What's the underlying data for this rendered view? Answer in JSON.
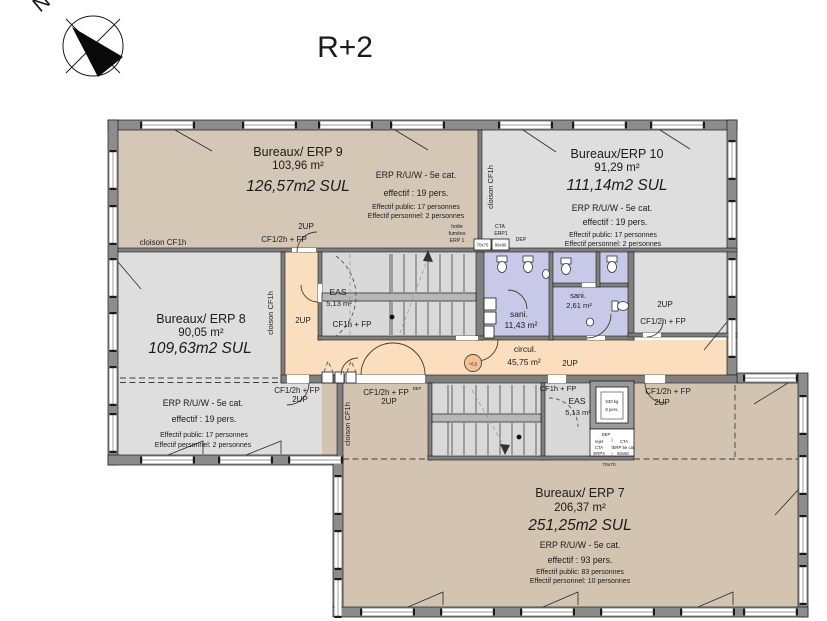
{
  "meta": {
    "floor_title": "R+2",
    "north_letter": "N"
  },
  "labels": {
    "two_up": "2UP",
    "cf_half_fp": "CF1/2h + FP",
    "cf1_fp": "CF1h + FP",
    "cloison": "cloison CF1h",
    "dep": "DEP",
    "level_marker": "+6,5"
  },
  "rooms": {
    "erp9": {
      "name": "Bureaux/ ERP 9",
      "area_m2": "103,96 m²",
      "area_sul": "126,57m2 SUL",
      "category": "ERP R/U/W - 5e cat.",
      "occupancy": "effectif : 19 pers.",
      "public": "Effectif public: 17 personnes",
      "staff": "Effectif personnel: 2 personnes"
    },
    "erp10": {
      "name": "Bureaux/ERP 10",
      "area_m2": "91,29 m²",
      "area_sul": "111,14m2 SUL",
      "category": "ERP R/U/W - 5e cat.",
      "occupancy": "effectif : 19 pers.",
      "public": "Effectif public: 17 personnes",
      "staff": "Effectif personnel: 2 personnes"
    },
    "erp8": {
      "name": "Bureaux/ ERP 8",
      "area_m2": "90,05 m²",
      "area_sul": "109,63m2 SUL",
      "category": "ERP R/U/W - 5e cat.",
      "occupancy": "effectif : 19 pers.",
      "public": "Effectif public: 17 personnes",
      "staff": "Effectif personnel: 2 personnes"
    },
    "erp7": {
      "name": "Bureaux/ ERP 7",
      "area_m2": "206,37 m²",
      "area_sul": "251,25m2 SUL",
      "category": "ERP R/U/W - 5e cat.",
      "occupancy": "effectif : 93 pers.",
      "public": "Effectif public: 83 personnes",
      "staff": "Effectif personnel: 10 personnes"
    },
    "circulation": {
      "name": "circul.",
      "area_m2": "45,75 m²"
    },
    "sani_main": {
      "name": "sani.",
      "area_m2": "11,43 m²"
    },
    "sani_small": {
      "name": "sani.",
      "area_m2": "2,61 m²"
    },
    "eas_upper": {
      "name": "EAS",
      "area_m2": "5,13 m²"
    },
    "eas_lower": {
      "name": "EAS",
      "area_m2": "5,13 m²"
    }
  },
  "equipment": {
    "hotte_l1": "hotte",
    "hotte_l2": "fumées",
    "hotte_l3": "ERP 1",
    "cta1_l1": "CTA",
    "cta1_l2": "ERP1",
    "duct_70x75": "70x75",
    "duct_80x80": "80x80",
    "lift_load": "630 kg",
    "lift_capacity": "8 pers.",
    "rejet_l1": "rejet",
    "rejet_l2": "CTA",
    "rejet_l3": "ERP3",
    "cta2_l1": "CTA",
    "cta2_l2": "ERP 5e cat.",
    "duct_60x60": "60x60",
    "duct_70x70": "70x70"
  },
  "colors": {
    "office_tan": "#d5c7b6",
    "office_grey": "#dedede",
    "stair_grey": "#d9d9d9",
    "corridor_peach": "#fadebd",
    "sanitary_lavender": "#c8c8e8",
    "wall_grey": "#8c8c8c"
  }
}
